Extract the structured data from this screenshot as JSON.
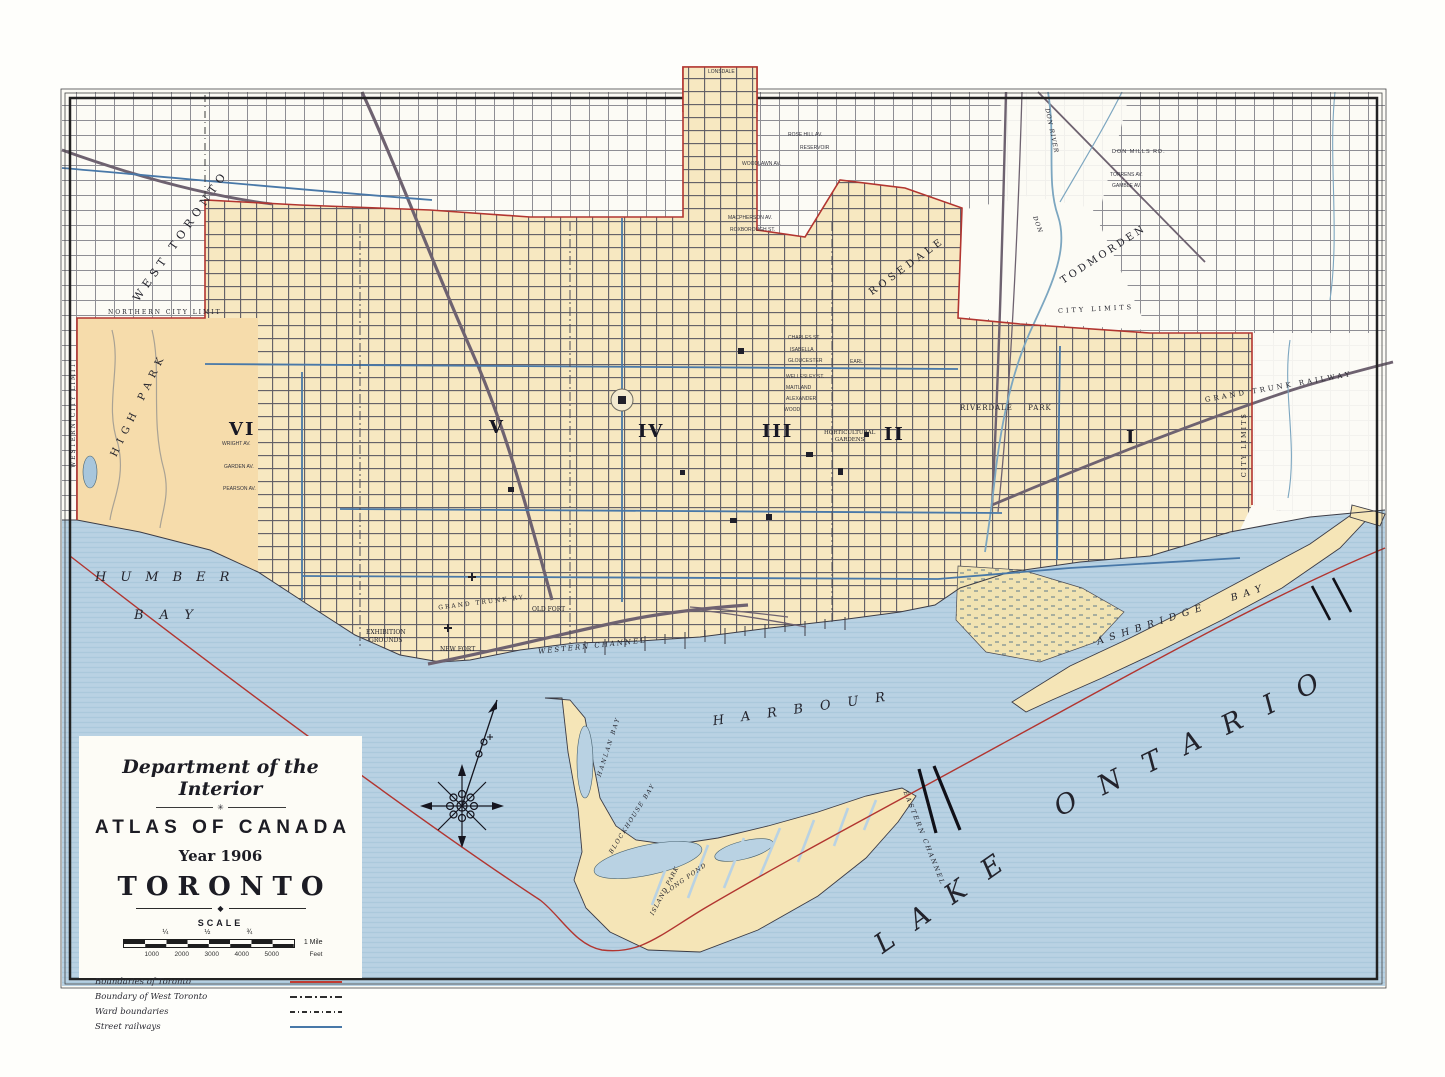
{
  "palette": {
    "water": "#b9d2e3",
    "city_fill": "#f7e8c1",
    "district_fill": "#f6dcab",
    "boundary_red": "#b23530",
    "street_railway_blue": "#4878a8",
    "steam_rail": "#6e6270",
    "street_line": "#5d5b63",
    "frame": "#222222"
  },
  "icons": {
    "compass_rose": "ornate eight-point compass rose with north needle"
  },
  "cartouche": {
    "department": "Department of the Interior",
    "ornament_star": "✳",
    "atlas_title": "ATLAS OF CANADA",
    "year": "Year 1906",
    "city": "TORONTO",
    "ornament_diamond": "◆",
    "scale_heading": "SCALE",
    "mile_ticks": [
      "¼",
      "½",
      "¾"
    ],
    "mile_end": "1 Mile",
    "feet_ticks": [
      "1000",
      "2000",
      "3000",
      "4000",
      "5000"
    ],
    "feet_end": "Feet",
    "legend": [
      {
        "label": "Boundaries of Toronto",
        "swatch": "red-solid"
      },
      {
        "label": "Boundary of West Toronto",
        "swatch": "black-dash"
      },
      {
        "label": "Ward boundaries",
        "swatch": "gray-dash-dot"
      },
      {
        "label": "Street railways",
        "swatch": "blue-solid"
      }
    ]
  },
  "wards": {
    "w1": "I",
    "w2": "II",
    "w3": "III",
    "w4": "IV",
    "w5": "V",
    "w6": "VI"
  },
  "water": {
    "humber": "HUMBER",
    "bay_humber": "BAY",
    "harbour": "HARBOUR",
    "ashbridge_bay": "ASHBRIDGE BAY",
    "lake": "LAKE",
    "ontario": "ONTARIO",
    "western_channel": "WESTERN CHANNEL",
    "eastern_channel": "EASTERN CHANNEL",
    "hanlan_bay": "HANLAN BAY",
    "blockhouse_bay": "BLOCKHOUSE BAY",
    "island_park": "ISLAND PARK",
    "long_pond": "LONG POND"
  },
  "places": {
    "west_toronto": "WEST TORONTO",
    "high_park": "HIGH PARK",
    "rosedale": "ROSEDALE",
    "todmorden": "TODMORDEN",
    "riverdale_park": "RIVERDALE  PARK",
    "grand_trunk_railway": "GRAND TRUNK RAILWAY",
    "grand_trunk_ry": "GRAND TRUNK RY.",
    "city_limits_e": "CITY LIMITS",
    "city_limits_ne": "CITY LIMITS",
    "northern_city_limit": "NORTHERN CITY LIMIT",
    "western_city_limit": "WESTERN CITY LIMIT",
    "exhibition_1": "EXHIBITION",
    "exhibition_2": "GROUNDS",
    "old_fort": "OLD FORT",
    "new_fort": "NEW FORT",
    "horticultural_1": "HORTICULTURAL",
    "horticultural_2": "GARDENS",
    "don_river": "DON RIVER",
    "don": "DON"
  },
  "streets": {
    "don_mills": "DON MILLS RD.",
    "torrens": "TORRENS AV.",
    "gamble": "GAMBLE AV.",
    "rose_hill": "ROSE HILL AV.",
    "reservoir": "RESERVOIR",
    "woodlawn": "WOODLAWN AV.",
    "macpherson": "MACPHERSON AV.",
    "roxborough": "ROXBOROUGH ST.",
    "charles": "CHARLES ST.",
    "isabella": "ISABELLA",
    "gloucester": "GLOUCESTER",
    "earl": "EARL",
    "wellesley": "WELLESLEY ST.",
    "maitland": "MAITLAND",
    "alexander": "ALEXANDER",
    "wood": "WOOD",
    "lonsdale": "LONSDALE",
    "wright": "WRIGHT AV.",
    "garden": "GARDEN AV.",
    "pearson": "PEARSON AV."
  }
}
